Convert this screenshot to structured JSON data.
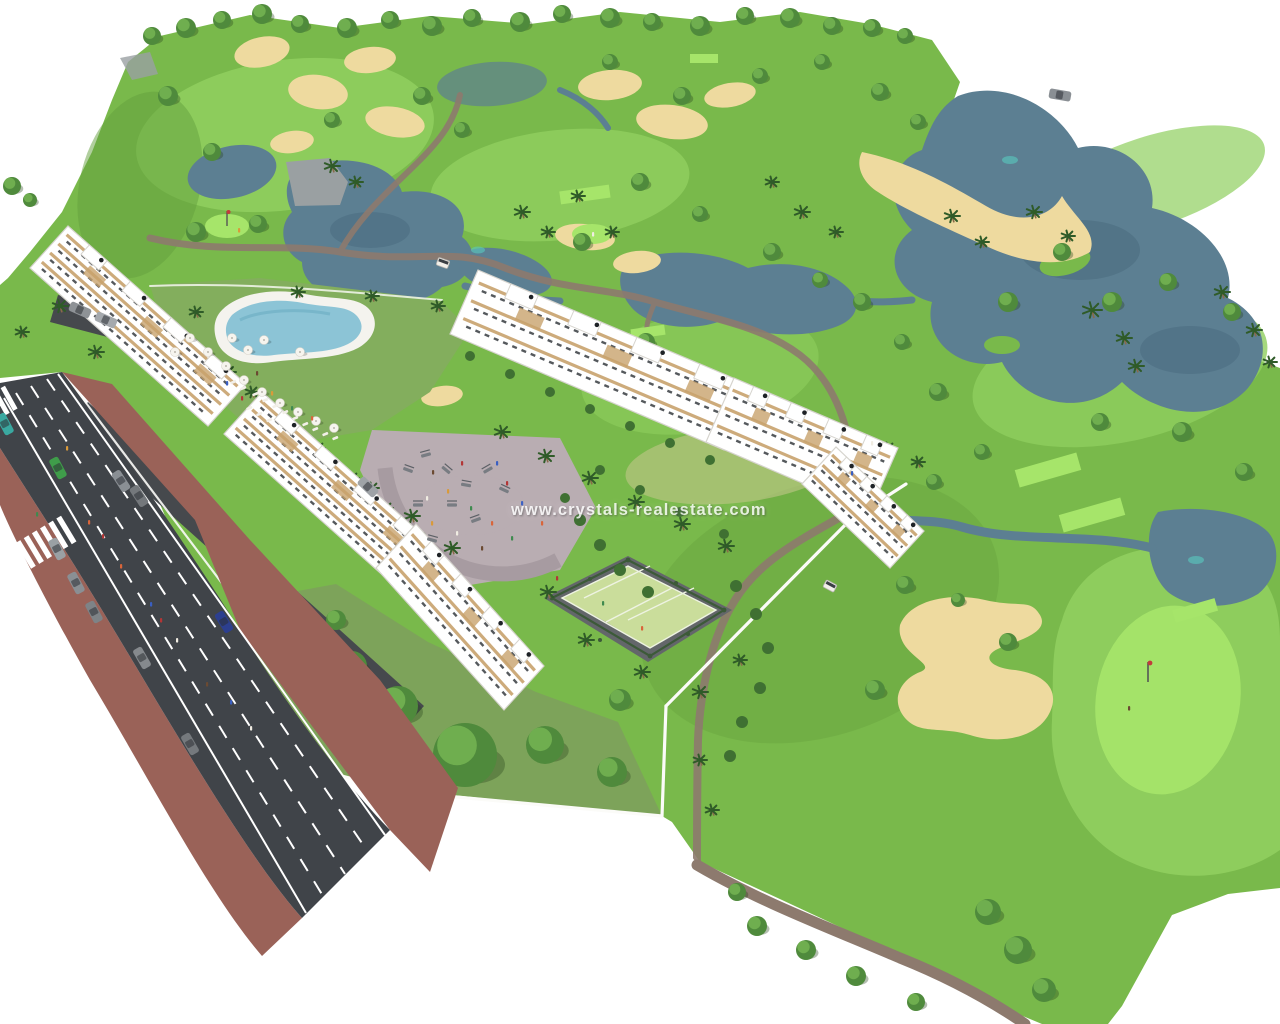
{
  "watermark": {
    "text": "www.crystals-realestate.com",
    "color": "#ffffff",
    "opacity": 0.82
  },
  "scene": {
    "description": "Aerial 3D architectural rendering of a white apartment complex with pool, playground, paddle courts and gardens beside a golf course with lakes, sand bunkers, palm trees and a boulevard with cars"
  },
  "palette": {
    "background": "#ffffff",
    "fairway_base": "#79b94b",
    "fairway_light": "#8fce5e",
    "fairway_bright": "#a6e56a",
    "fairway_dark": "#649f3d",
    "fairway_dry": "#c9c98f",
    "lake": "#5c7f92",
    "lake_dark": "#47697c",
    "lake_glint": "#59c9bf",
    "sand": "#eeda9f",
    "golf_path": "#8d7a6e",
    "road_asphalt": "#404449",
    "road_marking": "#ffffff",
    "sidewalk": "#9a6258",
    "plaza": "#b9adb2",
    "plaza_band": "#a79ba1",
    "driveway": "#46494d",
    "building_white": "#ffffff",
    "building_trim": "#d6d4ce",
    "wood_accent": "#c8a26d",
    "window_dark": "#383d41",
    "pool_water": "#8cc4d6",
    "pool_deck": "#f4f3ee",
    "court_surface": "#cadd9b",
    "court_fence": "#3c5a38",
    "court_ground": "#63666a",
    "tree_green": "#4f8a3c",
    "tree_light": "#6fae4f",
    "palm_green": "#2f5b28",
    "hedge_green": "#3f7032",
    "wall_white": "#fbfbf8",
    "watermark_color": "#ffffff",
    "people_colors": [
      "#d9653a",
      "#b33636",
      "#3a5fc2",
      "#f0ece2",
      "#6b4a32",
      "#d99a3a",
      "#3f8a4f"
    ]
  }
}
